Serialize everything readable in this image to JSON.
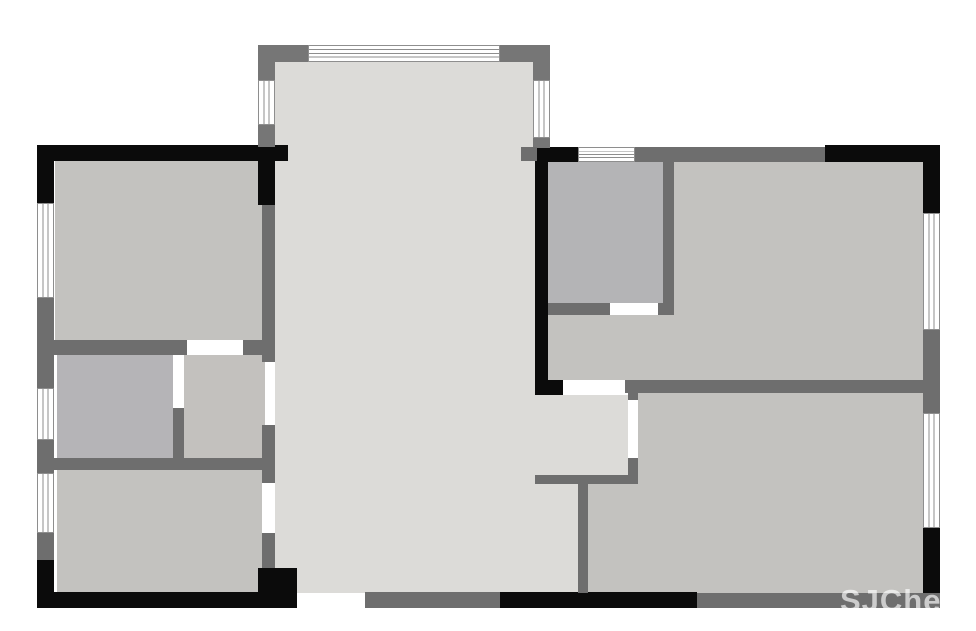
{
  "canvas": {
    "width": 976,
    "height": 631,
    "background": "#ffffff"
  },
  "palette": {
    "wall_black": "#0b0b0b",
    "wall_gray": "#6e6e6e",
    "wall_gray_light": "#767676",
    "window_line": "#8e8e8e",
    "fill_living": "#dcdbd8",
    "fill_bedroom": "#c3c2bf",
    "fill_bath": "#b5b4b7",
    "fill_closet": "#b4b4b6",
    "fill_small_room": "#c3c1be"
  },
  "watermark": {
    "text": "SJChees",
    "x": 840,
    "y": 583,
    "font_size": 31
  },
  "rooms": [
    {
      "name": "living-area-main",
      "x": 275,
      "y": 147,
      "w": 260,
      "h": 446,
      "fill": "#dcdbd8"
    },
    {
      "name": "living-area-bay",
      "x": 275,
      "y": 62,
      "w": 258,
      "h": 85,
      "fill": "#dcdbd8"
    },
    {
      "name": "hallway-nook",
      "x": 535,
      "y": 395,
      "w": 93,
      "h": 80,
      "fill": "#dcdbd8"
    },
    {
      "name": "living-area-strip",
      "x": 535,
      "y": 484,
      "w": 43,
      "h": 109,
      "fill": "#dcdbd8"
    },
    {
      "name": "bedroom-top-left",
      "x": 55,
      "y": 161,
      "w": 207,
      "h": 179,
      "fill": "#c3c2bf"
    },
    {
      "name": "bathroom-left",
      "x": 57,
      "y": 355,
      "w": 116,
      "h": 103,
      "fill": "#b5b4b7"
    },
    {
      "name": "small-room-center",
      "x": 184,
      "y": 355,
      "w": 81,
      "h": 103,
      "fill": "#c3c1be"
    },
    {
      "name": "bedroom-bottom-left",
      "x": 57,
      "y": 470,
      "w": 205,
      "h": 123,
      "fill": "#c3c2bf"
    },
    {
      "name": "master-bedroom",
      "x": 548,
      "y": 161,
      "w": 375,
      "h": 227,
      "fill": "#c3c2bf"
    },
    {
      "name": "closet-room",
      "x": 548,
      "y": 161,
      "w": 115,
      "h": 142,
      "fill": "#b4b4b6"
    },
    {
      "name": "bedroom-bottom-right-upper",
      "x": 638,
      "y": 393,
      "w": 285,
      "h": 82,
      "fill": "#c3c2bf"
    },
    {
      "name": "bedroom-bottom-right-lower",
      "x": 588,
      "y": 475,
      "w": 335,
      "h": 118,
      "fill": "#c3c2bf"
    }
  ],
  "walls": [
    {
      "name": "wall-top-left-exterior",
      "x": 37,
      "y": 145,
      "w": 251,
      "h": 16,
      "color": "#0b0b0b"
    },
    {
      "name": "wall-left-upper-corner",
      "x": 37,
      "y": 145,
      "w": 17,
      "h": 60,
      "color": "#0b0b0b"
    },
    {
      "name": "wall-leftwing-right-upper",
      "x": 258,
      "y": 145,
      "w": 17,
      "h": 60,
      "color": "#0b0b0b"
    },
    {
      "name": "wall-left-lower-corner",
      "x": 37,
      "y": 558,
      "w": 17,
      "h": 50,
      "color": "#0b0b0b"
    },
    {
      "name": "wall-bottom-left-exterior",
      "x": 37,
      "y": 592,
      "w": 260,
      "h": 16,
      "color": "#0b0b0b"
    },
    {
      "name": "wall-bottom-left-block",
      "x": 258,
      "y": 568,
      "w": 39,
      "h": 40,
      "color": "#0b0b0b"
    },
    {
      "name": "wall-center-right-vertical",
      "x": 535,
      "y": 148,
      "w": 13,
      "h": 247,
      "color": "#0b0b0b"
    },
    {
      "name": "wall-rightwing-top-black-left",
      "x": 535,
      "y": 147,
      "w": 43,
      "h": 15,
      "color": "#0b0b0b"
    },
    {
      "name": "wall-master-doorpost",
      "x": 535,
      "y": 380,
      "w": 28,
      "h": 15,
      "color": "#0b0b0b"
    },
    {
      "name": "wall-top-right-exterior",
      "x": 825,
      "y": 145,
      "w": 115,
      "h": 17,
      "color": "#0b0b0b"
    },
    {
      "name": "wall-right-upper-corner",
      "x": 923,
      "y": 145,
      "w": 17,
      "h": 68,
      "color": "#0b0b0b"
    },
    {
      "name": "wall-bottom-center-black",
      "x": 500,
      "y": 592,
      "w": 197,
      "h": 16,
      "color": "#0b0b0b"
    },
    {
      "name": "wall-right-lower-corner",
      "x": 923,
      "y": 528,
      "w": 17,
      "h": 80,
      "color": "#0b0b0b"
    },
    {
      "name": "wall-left-pier-1",
      "x": 37,
      "y": 298,
      "w": 17,
      "h": 90,
      "color": "#6e6e6e"
    },
    {
      "name": "wall-left-pier-2",
      "x": 37,
      "y": 440,
      "w": 17,
      "h": 33,
      "color": "#6e6e6e"
    },
    {
      "name": "wall-left-pier-3",
      "x": 37,
      "y": 533,
      "w": 17,
      "h": 27,
      "color": "#6e6e6e"
    },
    {
      "name": "wall-below-bedroom-tl-left",
      "x": 37,
      "y": 340,
      "w": 150,
      "h": 15,
      "color": "#6e6e6e"
    },
    {
      "name": "wall-below-bedroom-tl-right",
      "x": 243,
      "y": 340,
      "w": 27,
      "h": 15,
      "color": "#6e6e6e"
    },
    {
      "name": "wall-leftwing-right-a",
      "x": 262,
      "y": 205,
      "w": 13,
      "h": 157,
      "color": "#6e6e6e"
    },
    {
      "name": "wall-leftwing-right-b",
      "x": 262,
      "y": 425,
      "w": 13,
      "h": 58,
      "color": "#6e6e6e"
    },
    {
      "name": "wall-leftwing-right-c",
      "x": 262,
      "y": 533,
      "w": 13,
      "h": 35,
      "color": "#6e6e6e"
    },
    {
      "name": "wall-bath-divider",
      "x": 173,
      "y": 408,
      "w": 11,
      "h": 50,
      "color": "#6e6e6e"
    },
    {
      "name": "wall-below-small-rooms",
      "x": 37,
      "y": 458,
      "w": 238,
      "h": 12,
      "color": "#6e6e6e"
    },
    {
      "name": "wall-bay-topleft-h",
      "x": 258,
      "y": 45,
      "w": 50,
      "h": 17,
      "color": "#767676"
    },
    {
      "name": "wall-bay-topleft-v",
      "x": 258,
      "y": 45,
      "w": 17,
      "h": 35,
      "color": "#767676"
    },
    {
      "name": "wall-bay-topright-h",
      "x": 500,
      "y": 45,
      "w": 50,
      "h": 17,
      "color": "#767676"
    },
    {
      "name": "wall-bay-topright-v",
      "x": 533,
      "y": 45,
      "w": 17,
      "h": 35,
      "color": "#767676"
    },
    {
      "name": "wall-bay-left-lower",
      "x": 258,
      "y": 125,
      "w": 17,
      "h": 22,
      "color": "#767676"
    },
    {
      "name": "wall-bay-right-lower",
      "x": 533,
      "y": 138,
      "w": 17,
      "h": 10,
      "color": "#767676"
    },
    {
      "name": "wall-bay-right-junction",
      "x": 521,
      "y": 147,
      "w": 16,
      "h": 14,
      "color": "#6e6e6e"
    },
    {
      "name": "wall-rightwing-top-gray",
      "x": 635,
      "y": 147,
      "w": 190,
      "h": 15,
      "color": "#6e6e6e"
    },
    {
      "name": "wall-closet-right",
      "x": 663,
      "y": 161,
      "w": 11,
      "h": 154,
      "color": "#6e6e6e"
    },
    {
      "name": "wall-closet-bottom-left",
      "x": 548,
      "y": 303,
      "w": 62,
      "h": 12,
      "color": "#6e6e6e"
    },
    {
      "name": "wall-closet-bottom-corner",
      "x": 658,
      "y": 303,
      "w": 16,
      "h": 12,
      "color": "#6e6e6e"
    },
    {
      "name": "wall-master-bottom",
      "x": 625,
      "y": 380,
      "w": 298,
      "h": 13,
      "color": "#6e6e6e"
    },
    {
      "name": "wall-right-pier-mid",
      "x": 923,
      "y": 330,
      "w": 17,
      "h": 83,
      "color": "#6e6e6e"
    },
    {
      "name": "wall-bedroom2-doorpost-top",
      "x": 628,
      "y": 393,
      "w": 10,
      "h": 7,
      "color": "#6e6e6e"
    },
    {
      "name": "wall-bedroom2-left-lower",
      "x": 628,
      "y": 458,
      "w": 10,
      "h": 17,
      "color": "#6e6e6e"
    },
    {
      "name": "wall-hallway-bottom",
      "x": 535,
      "y": 475,
      "w": 103,
      "h": 9,
      "color": "#6e6e6e"
    },
    {
      "name": "wall-living-bedroom2-vertical",
      "x": 578,
      "y": 484,
      "w": 10,
      "h": 109,
      "color": "#6e6e6e"
    },
    {
      "name": "wall-bottom-gray-left",
      "x": 365,
      "y": 592,
      "w": 135,
      "h": 16,
      "color": "#6e6e6e"
    },
    {
      "name": "wall-bottom-gray-right",
      "x": 697,
      "y": 593,
      "w": 243,
      "h": 15,
      "color": "#6e6e6e"
    }
  ],
  "windows": [
    {
      "name": "window-left-top",
      "x": 37,
      "y": 203,
      "w": 17,
      "h": 95,
      "dir": "v"
    },
    {
      "name": "window-left-middle",
      "x": 37,
      "y": 388,
      "w": 17,
      "h": 52,
      "dir": "v"
    },
    {
      "name": "window-left-bottom",
      "x": 37,
      "y": 473,
      "w": 17,
      "h": 60,
      "dir": "v"
    },
    {
      "name": "window-bay-top",
      "x": 308,
      "y": 45,
      "w": 192,
      "h": 17,
      "dir": "h"
    },
    {
      "name": "window-bay-left",
      "x": 258,
      "y": 80,
      "w": 17,
      "h": 45,
      "dir": "v"
    },
    {
      "name": "window-bay-right",
      "x": 533,
      "y": 80,
      "w": 17,
      "h": 58,
      "dir": "v"
    },
    {
      "name": "window-rightwing-top",
      "x": 578,
      "y": 147,
      "w": 57,
      "h": 15,
      "dir": "h"
    },
    {
      "name": "window-right-upper",
      "x": 923,
      "y": 213,
      "w": 17,
      "h": 117,
      "dir": "v"
    },
    {
      "name": "window-right-lower",
      "x": 923,
      "y": 413,
      "w": 17,
      "h": 115,
      "dir": "v"
    }
  ],
  "doors": [
    {
      "name": "door-closet",
      "x": 610,
      "y": 303,
      "w": 48,
      "h": 12
    },
    {
      "name": "door-master",
      "x": 563,
      "y": 380,
      "w": 62,
      "h": 15
    }
  ]
}
